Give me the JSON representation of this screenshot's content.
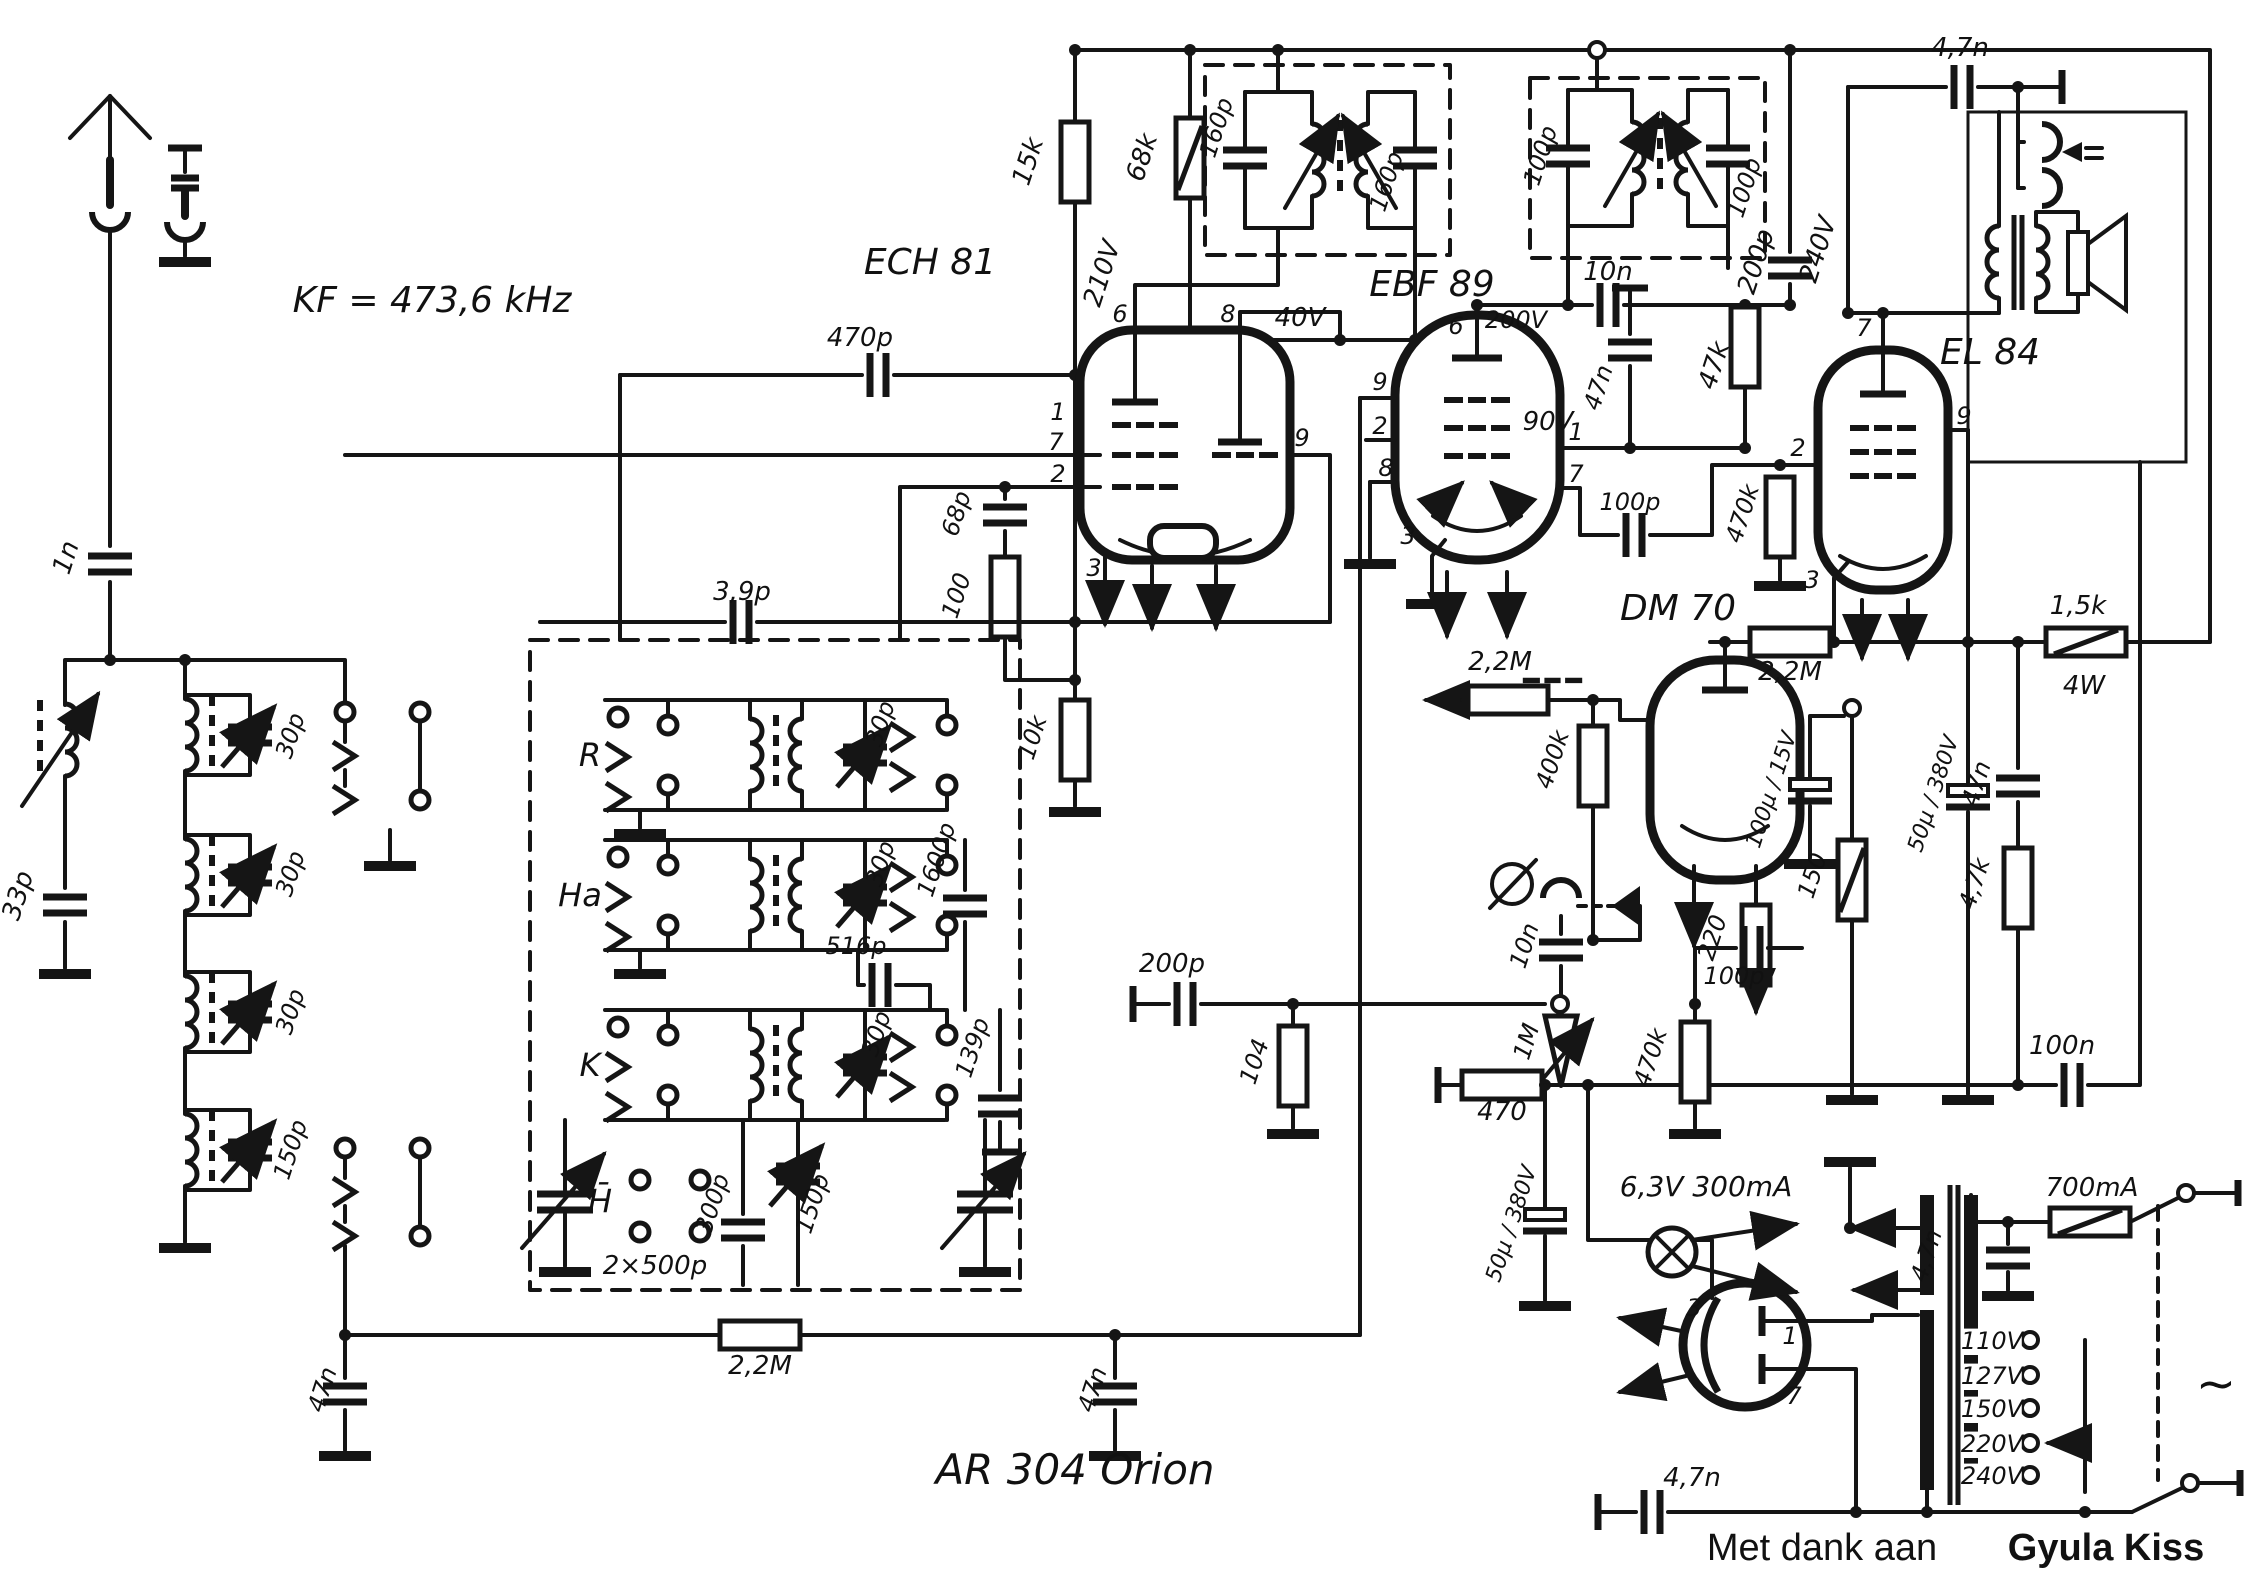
{
  "document": {
    "type": "radio-schematic",
    "model": "AR 304   Orion",
    "if_frequency": "KF = 473,6 kHz",
    "credit": "Met dank aan Gyula Kiss",
    "tubes": [
      "ECH 81",
      "EBF 89",
      "EL 84",
      "DM 70"
    ],
    "band_labels": [
      "R",
      "Ha",
      "K",
      "H̄"
    ],
    "mains_taps": [
      "110V",
      "127V",
      "150V",
      "220V",
      "240V"
    ],
    "fuse": "700mA",
    "pilot_lamp": "6,3V 300mA"
  },
  "labels": [
    {
      "n": "if-frequency",
      "t": "KF = 473,6 kHz",
      "x": 432,
      "y": 312,
      "s": 36
    },
    {
      "n": "cap-1n",
      "t": "1n",
      "x": 74,
      "y": 560,
      "r": -72
    },
    {
      "n": "cap-33p",
      "t": "33p",
      "x": 26,
      "y": 898,
      "r": -72
    },
    {
      "n": "trim-30p-a",
      "t": "30p",
      "x": 298,
      "y": 738,
      "r": -72,
      "s": 24
    },
    {
      "n": "trim-30p-b",
      "t": "30p",
      "x": 298,
      "y": 876,
      "r": -72,
      "s": 24
    },
    {
      "n": "trim-30p-c",
      "t": "30p",
      "x": 298,
      "y": 1014,
      "r": -72,
      "s": 24
    },
    {
      "n": "trim-150p",
      "t": "150p",
      "x": 298,
      "y": 1152,
      "r": -72,
      "s": 24
    },
    {
      "n": "band-r",
      "t": "R",
      "x": 590,
      "y": 766,
      "s": 32
    },
    {
      "n": "band-ha",
      "t": "Ha",
      "x": 580,
      "y": 906,
      "s": 32
    },
    {
      "n": "band-k",
      "t": "K",
      "x": 590,
      "y": 1076,
      "s": 32
    },
    {
      "n": "band-h",
      "t": "H̄",
      "x": 600,
      "y": 1212,
      "s": 32
    },
    {
      "n": "cap-3p9",
      "t": "3,9p",
      "x": 742,
      "y": 600
    },
    {
      "n": "trim-30p-r",
      "t": "30p",
      "x": 888,
      "y": 726,
      "r": -72,
      "s": 24
    },
    {
      "n": "trim-30p-ha",
      "t": "30p",
      "x": 888,
      "y": 866,
      "r": -72,
      "s": 24
    },
    {
      "n": "trim-30p-k",
      "t": "30p",
      "x": 884,
      "y": 1036,
      "r": -72,
      "s": 24
    },
    {
      "n": "cap-300p",
      "t": "300p",
      "x": 720,
      "y": 1206,
      "r": -72,
      "s": 24
    },
    {
      "n": "trim-150p-2",
      "t": "150p",
      "x": 820,
      "y": 1206,
      "r": -72,
      "s": 24
    },
    {
      "n": "cap-516p",
      "t": "516p",
      "x": 856,
      "y": 954,
      "s": 24
    },
    {
      "n": "cap-1600p",
      "t": "1600p",
      "x": 944,
      "y": 862,
      "r": -72,
      "s": 24
    },
    {
      "n": "cap-139p",
      "t": "139p",
      "x": 980,
      "y": 1050,
      "r": -72,
      "s": 24
    },
    {
      "n": "tuning-gang",
      "t": "2×500p",
      "x": 655,
      "y": 1274
    },
    {
      "n": "res-2m2-agc",
      "t": "2,2M",
      "x": 760,
      "y": 1374
    },
    {
      "n": "cap-47n-agc1",
      "t": "47n",
      "x": 330,
      "y": 1392,
      "r": -72,
      "s": 24
    },
    {
      "n": "cap-47n-agc2",
      "t": "47n",
      "x": 1100,
      "y": 1392,
      "r": -72,
      "s": 24
    },
    {
      "n": "model",
      "t": "AR 304   Orion",
      "x": 1075,
      "y": 1484,
      "s": 42
    },
    {
      "n": "cap-470p",
      "t": "470p",
      "x": 860,
      "y": 346
    },
    {
      "n": "tube-ech81-label",
      "t": "ECH 81",
      "x": 930,
      "y": 274,
      "s": 36
    },
    {
      "n": "cap-68p",
      "t": "68p",
      "x": 964,
      "y": 516,
      "r": -72,
      "s": 24
    },
    {
      "n": "res-100",
      "t": "100",
      "x": 964,
      "y": 598,
      "r": -72,
      "s": 24
    },
    {
      "n": "res-10k",
      "t": "10k",
      "x": 1040,
      "y": 740,
      "r": -72,
      "s": 24
    },
    {
      "n": "res-15k",
      "t": "15k",
      "x": 1036,
      "y": 164,
      "r": -72
    },
    {
      "n": "res-68k",
      "t": "68k",
      "x": 1150,
      "y": 160,
      "r": -72
    },
    {
      "n": "cap-160p-1",
      "t": "160p",
      "x": 1224,
      "y": 130,
      "r": -72,
      "s": 24
    },
    {
      "n": "cap-160p-2",
      "t": "160p",
      "x": 1394,
      "y": 184,
      "r": -72,
      "s": 24
    },
    {
      "n": "v-210",
      "t": "210V",
      "x": 1110,
      "y": 276,
      "r": -72
    },
    {
      "n": "v-40",
      "t": "40V",
      "x": 1300,
      "y": 326
    },
    {
      "n": "cap-100p-ift2a",
      "t": "100p",
      "x": 1548,
      "y": 158,
      "r": -72,
      "s": 24
    },
    {
      "n": "cap-100p-ift2b",
      "t": "100p",
      "x": 1752,
      "y": 190,
      "r": -72,
      "s": 24
    },
    {
      "n": "tube-ebf89-label",
      "t": "EBF 89",
      "x": 1432,
      "y": 296,
      "s": 36
    },
    {
      "n": "v-200",
      "t": "200V",
      "x": 1516,
      "y": 328,
      "s": 24
    },
    {
      "n": "cap-10n",
      "t": "10n",
      "x": 1608,
      "y": 280
    },
    {
      "n": "cap-47n-sc",
      "t": "47n",
      "x": 1606,
      "y": 390,
      "r": -72,
      "s": 24
    },
    {
      "n": "res-47k",
      "t": "47k",
      "x": 1722,
      "y": 368,
      "r": -72
    },
    {
      "n": "cap-200p-top",
      "t": "200p",
      "x": 1764,
      "y": 264,
      "r": -72
    },
    {
      "n": "v-240",
      "t": "240V",
      "x": 1826,
      "y": 252,
      "r": -72
    },
    {
      "n": "cap-4n7-top",
      "t": "4,7n",
      "x": 1960,
      "y": 56
    },
    {
      "n": "tube-el84-label",
      "t": "EL 84",
      "x": 1990,
      "y": 364,
      "s": 36
    },
    {
      "n": "v-90",
      "t": "90V",
      "x": 1548,
      "y": 430
    },
    {
      "n": "cap-100p-cpl",
      "t": "100p",
      "x": 1630,
      "y": 510,
      "s": 24
    },
    {
      "n": "res-470k-g",
      "t": "470k",
      "x": 1750,
      "y": 516,
      "r": -72,
      "s": 24
    },
    {
      "n": "tube-dm70-label",
      "t": "DM 70",
      "x": 1678,
      "y": 620,
      "s": 36
    },
    {
      "n": "res-2m2-b",
      "t": "2,2M",
      "x": 1790,
      "y": 680
    },
    {
      "n": "res-2m2-a",
      "t": "2,2M",
      "x": 1500,
      "y": 670
    },
    {
      "n": "res-400k",
      "t": "400k",
      "x": 1560,
      "y": 762,
      "r": -72,
      "s": 24
    },
    {
      "n": "res-1k5",
      "t": "1,5k",
      "x": 2078,
      "y": 614
    },
    {
      "n": "res-1k5-w",
      "t": "4W",
      "x": 2084,
      "y": 694
    },
    {
      "n": "cap-100u",
      "t": "100µ / 15V",
      "x": 1778,
      "y": 792,
      "r": -72,
      "s": 22
    },
    {
      "n": "cap-50u-b",
      "t": "50µ / 380V",
      "x": 1940,
      "y": 796,
      "r": -72,
      "s": 22
    },
    {
      "n": "cap-47n-fb",
      "t": "47n",
      "x": 1984,
      "y": 786,
      "r": -72,
      "s": 24
    },
    {
      "n": "res-220",
      "t": "220",
      "x": 1720,
      "y": 940,
      "r": -72,
      "s": 24
    },
    {
      "n": "res-150",
      "t": "150",
      "x": 1820,
      "y": 878,
      "r": -72,
      "s": 24
    },
    {
      "n": "res-4k7",
      "t": "4,7k",
      "x": 1982,
      "y": 886,
      "r": -72,
      "s": 24
    },
    {
      "n": "cap-100n",
      "t": "100n",
      "x": 2062,
      "y": 1054
    },
    {
      "n": "cap-200p-det",
      "t": "200p",
      "x": 1172,
      "y": 972
    },
    {
      "n": "res-104",
      "t": "104",
      "x": 1262,
      "y": 1064,
      "r": -72,
      "s": 24
    },
    {
      "n": "cap-10n-det",
      "t": "10n",
      "x": 1532,
      "y": 948,
      "r": -72,
      "s": 24
    },
    {
      "n": "pot-1m",
      "t": "1M",
      "x": 1534,
      "y": 1044,
      "r": -72,
      "s": 24
    },
    {
      "n": "res-470k-det",
      "t": "470k",
      "x": 1658,
      "y": 1060,
      "r": -72,
      "s": 24
    },
    {
      "n": "cap-100p-det",
      "t": "100p",
      "x": 1734,
      "y": 984,
      "s": 24
    },
    {
      "n": "res-470",
      "t": "470",
      "x": 1502,
      "y": 1120
    },
    {
      "n": "cap-50u-a",
      "t": "50µ / 380V",
      "x": 1518,
      "y": 1226,
      "r": -72,
      "s": 22
    },
    {
      "n": "pilot-lamp-label",
      "t": "6,3V 300mA",
      "x": 1706,
      "y": 1196,
      "s": 28
    },
    {
      "n": "cap-4n7-ps",
      "t": "4,7n",
      "x": 1934,
      "y": 1258,
      "r": -72,
      "s": 24
    },
    {
      "n": "fuse-label",
      "t": "700mA",
      "x": 2092,
      "y": 1196
    },
    {
      "n": "tap-110",
      "t": "110V",
      "x": 1992,
      "y": 1349,
      "s": 24,
      "bg": 1
    },
    {
      "n": "tap-127",
      "t": "127V",
      "x": 1992,
      "y": 1384,
      "s": 24,
      "bg": 1
    },
    {
      "n": "tap-150",
      "t": "150V",
      "x": 1992,
      "y": 1417,
      "s": 24,
      "bg": 1
    },
    {
      "n": "tap-220",
      "t": "220V",
      "x": 1992,
      "y": 1452,
      "s": 24,
      "bg": 1
    },
    {
      "n": "tap-240",
      "t": "240V",
      "x": 1992,
      "y": 1484,
      "s": 24,
      "bg": 1
    },
    {
      "n": "mains-ac",
      "t": "~",
      "x": 2216,
      "y": 1400,
      "s": 48
    },
    {
      "n": "cap-4n7-btm",
      "t": "4,7n",
      "x": 1692,
      "y": 1486
    },
    {
      "n": "credit-prefix",
      "t": "Met dank aan",
      "x": 1822,
      "y": 1560,
      "s": 38,
      "f": "sans"
    },
    {
      "n": "credit-name",
      "t": "Gyula Kiss",
      "x": 2106,
      "y": 1560,
      "s": 38,
      "f": "sansb"
    },
    {
      "n": "ech81-pin6",
      "t": "6",
      "x": 1120,
      "y": 322,
      "s": 24
    },
    {
      "n": "ech81-pin8",
      "t": "8",
      "x": 1228,
      "y": 322,
      "s": 24
    },
    {
      "n": "ech81-pin1",
      "t": "1",
      "x": 1058,
      "y": 420,
      "s": 24
    },
    {
      "n": "ech81-pin7",
      "t": "7",
      "x": 1056,
      "y": 450,
      "s": 24
    },
    {
      "n": "ech81-pin2",
      "t": "2",
      "x": 1058,
      "y": 482,
      "s": 24
    },
    {
      "n": "ech81-pin9",
      "t": "9",
      "x": 1302,
      "y": 446,
      "s": 24
    },
    {
      "n": "ech81-pin3",
      "t": "3",
      "x": 1094,
      "y": 576,
      "s": 24
    },
    {
      "n": "ebf89-pin6",
      "t": "6",
      "x": 1456,
      "y": 334,
      "s": 24
    },
    {
      "n": "ebf89-pin9",
      "t": "9",
      "x": 1380,
      "y": 390,
      "s": 24
    },
    {
      "n": "ebf89-pin2",
      "t": "2",
      "x": 1380,
      "y": 434,
      "s": 24
    },
    {
      "n": "ebf89-pin8",
      "t": "8",
      "x": 1386,
      "y": 476,
      "s": 24
    },
    {
      "n": "ebf89-pin1",
      "t": "1",
      "x": 1576,
      "y": 440,
      "s": 24
    },
    {
      "n": "ebf89-pin7",
      "t": "7",
      "x": 1576,
      "y": 482,
      "s": 24
    },
    {
      "n": "ebf89-pin3",
      "t": "3",
      "x": 1408,
      "y": 544,
      "s": 24
    },
    {
      "n": "el84-pin7",
      "t": "7",
      "x": 1864,
      "y": 336,
      "s": 24
    },
    {
      "n": "el84-pin9",
      "t": "9",
      "x": 1964,
      "y": 424,
      "s": 24
    },
    {
      "n": "el84-pin2",
      "t": "2",
      "x": 1798,
      "y": 456,
      "s": 24
    },
    {
      "n": "el84-pin3",
      "t": "3",
      "x": 1812,
      "y": 588,
      "s": 24
    },
    {
      "n": "rect-pin3",
      "t": "3",
      "x": 1694,
      "y": 1316,
      "s": 24
    },
    {
      "n": "rect-pin1",
      "t": "1",
      "x": 1790,
      "y": 1344,
      "s": 24
    },
    {
      "n": "rect-pin7",
      "t": "7",
      "x": 1794,
      "y": 1404,
      "s": 24
    }
  ]
}
